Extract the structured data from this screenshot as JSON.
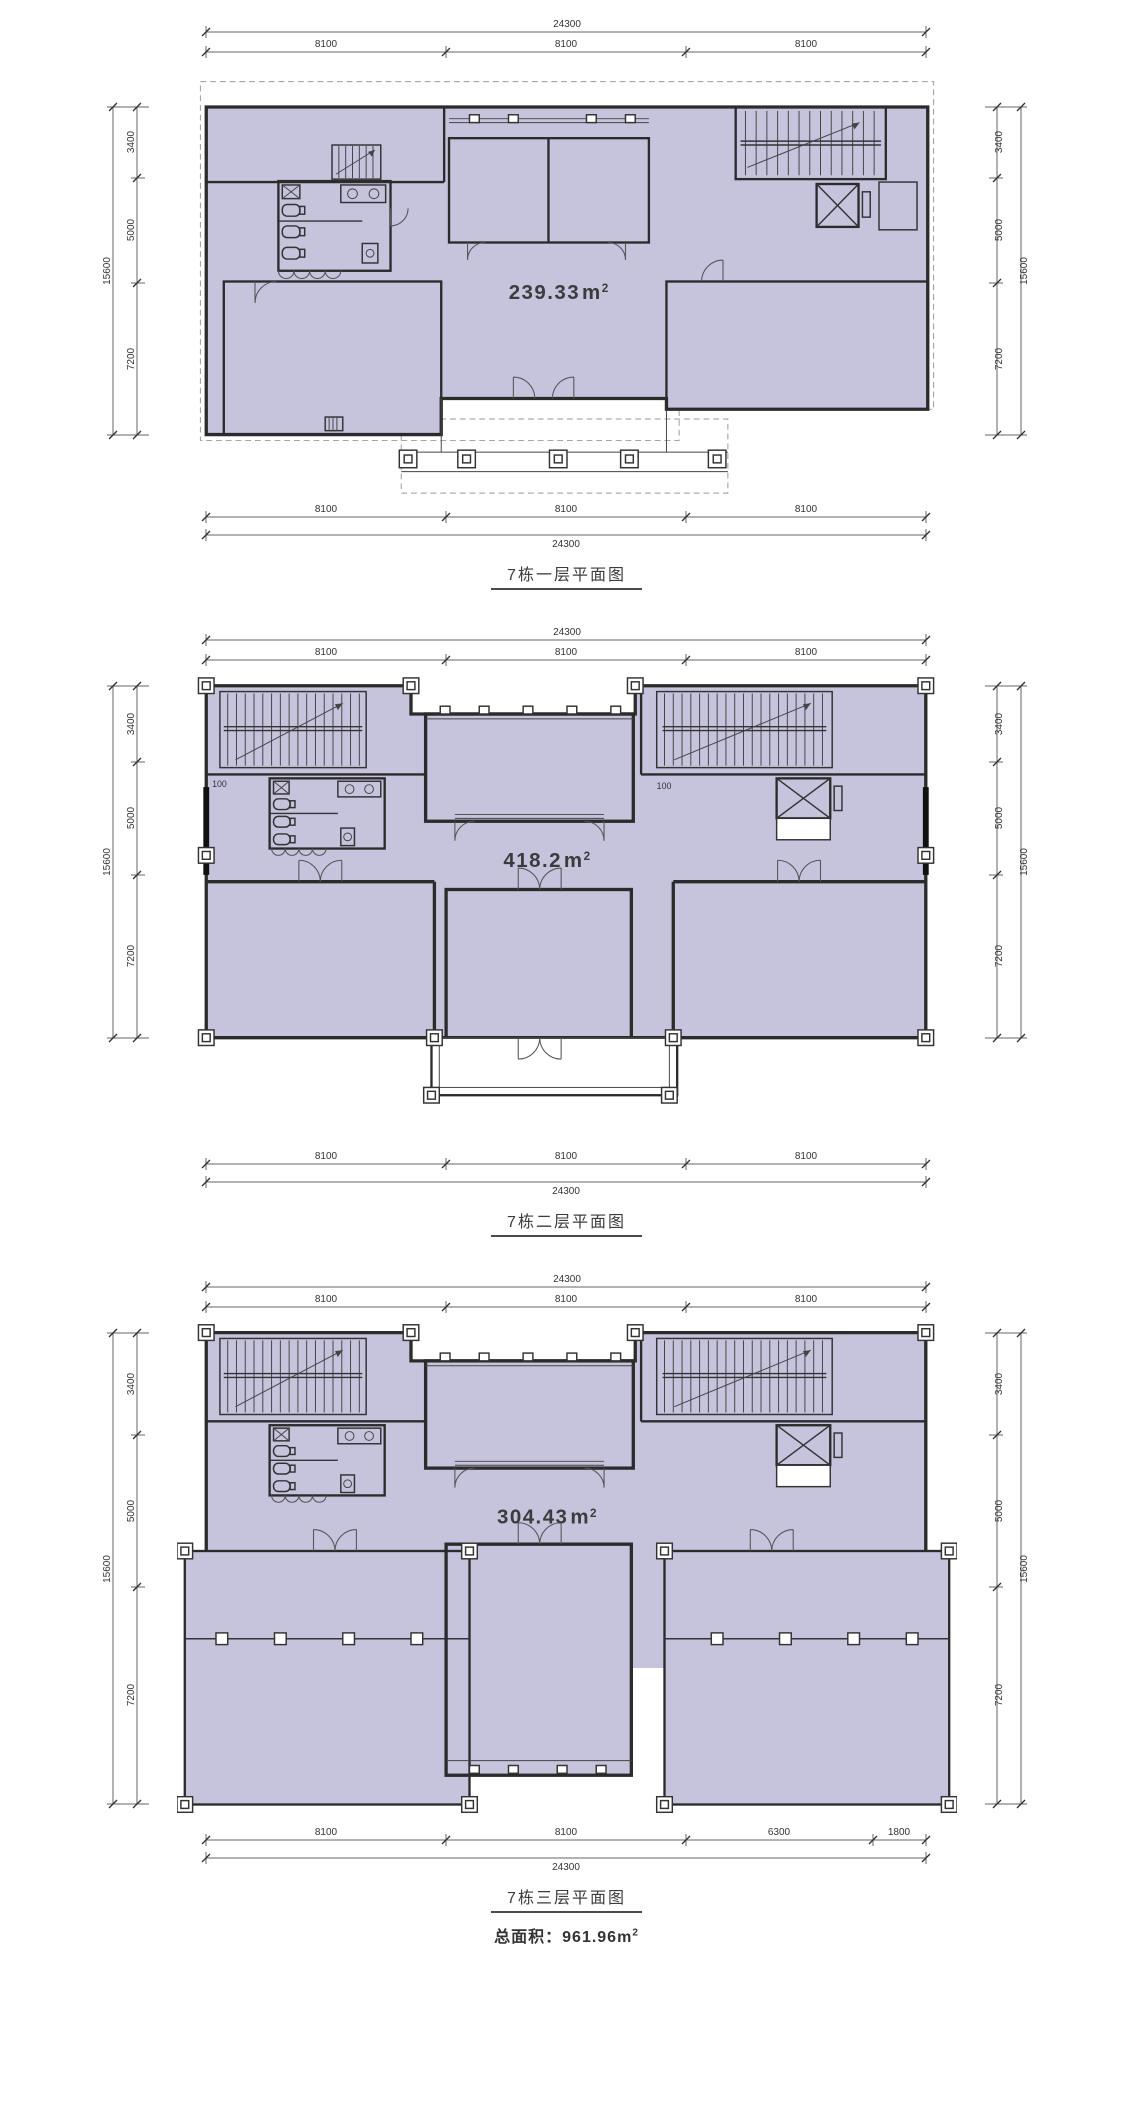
{
  "page": {
    "background": "#ffffff"
  },
  "colors": {
    "room_fill": "#c6c3dd",
    "wall": "#2b2b2b",
    "dimension_line": "#666666",
    "dimension_text": "#333333",
    "dashed_outline": "#9a9a9a",
    "title_text": "#3c3c3c"
  },
  "plans": [
    {
      "name": "floor-1",
      "title": "7栋一层平面图",
      "area": {
        "value": "239.33",
        "unit": "m",
        "sup": "2"
      },
      "dims": {
        "top": {
          "total": "24300",
          "segments": [
            "8100",
            "8100",
            "8100"
          ]
        },
        "bottom": {
          "total": "24300",
          "segments": [
            "8100",
            "8100",
            "8100"
          ]
        },
        "left": {
          "total": "15600",
          "segments": [
            "3400",
            "5000",
            "7200"
          ]
        },
        "right": {
          "total": "15600",
          "segments": [
            "3400",
            "5000",
            "7200"
          ]
        }
      }
    },
    {
      "name": "floor-2",
      "title": "7栋二层平面图",
      "area": {
        "value": "418.2",
        "unit": "m",
        "sup": "2"
      },
      "annotations": [
        "100",
        "100"
      ],
      "dims": {
        "top": {
          "total": "24300",
          "segments": [
            "8100",
            "8100",
            "8100"
          ]
        },
        "bottom": {
          "total": "24300",
          "segments": [
            "8100",
            "8100",
            "8100"
          ]
        },
        "left": {
          "total": "15600",
          "segments": [
            "3400",
            "5000",
            "7200"
          ]
        },
        "right": {
          "total": "15600",
          "segments": [
            "3400",
            "5000",
            "7200"
          ]
        }
      }
    },
    {
      "name": "floor-3",
      "title": "7栋三层平面图",
      "area": {
        "value": "304.43",
        "unit": "m",
        "sup": "2"
      },
      "dims": {
        "top": {
          "total": "24300",
          "segments": [
            "8100",
            "8100",
            "8100"
          ]
        },
        "bottom": {
          "total": "24300",
          "segments": [
            "8100",
            "8100",
            "6300",
            "1800"
          ]
        },
        "left": {
          "total": "15600",
          "segments": [
            "3400",
            "5000",
            "7200"
          ]
        },
        "right": {
          "total": "15600",
          "segments": [
            "3400",
            "5000",
            "7200"
          ]
        }
      }
    }
  ],
  "footer": {
    "label": "总面积：",
    "value": "961.96",
    "unit": "m",
    "sup": "2"
  }
}
